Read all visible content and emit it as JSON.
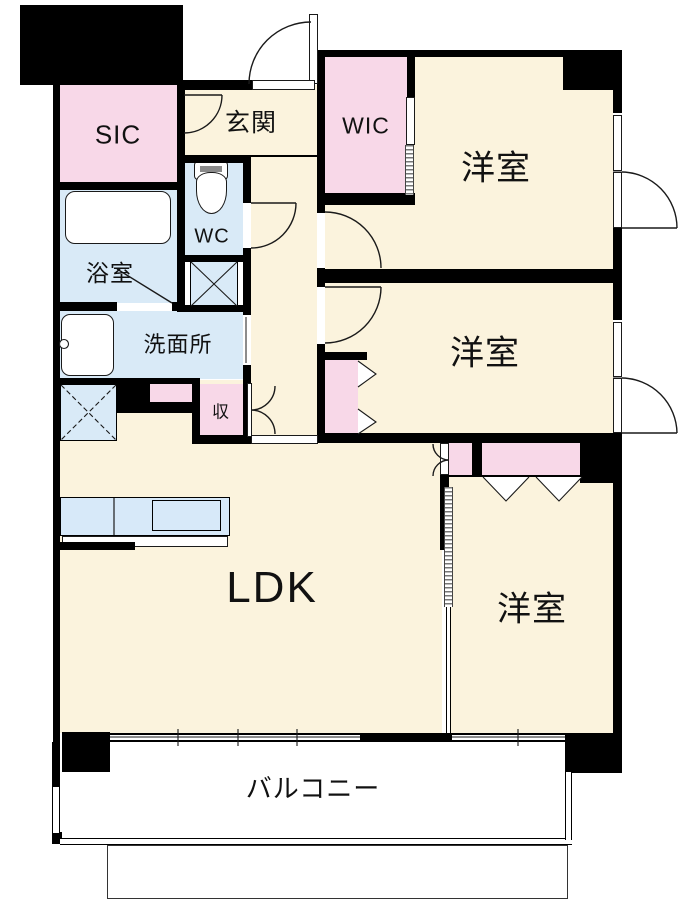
{
  "floorplan": {
    "type": "apartment-floor-plan",
    "rooms": {
      "sic": {
        "label": "SIC"
      },
      "genkan": {
        "label": "玄関"
      },
      "wic": {
        "label": "WIC"
      },
      "bedroom_top": {
        "label": "洋室"
      },
      "wc": {
        "label": "WC"
      },
      "bathroom": {
        "label": "浴室"
      },
      "washroom": {
        "label": "洗面所"
      },
      "bedroom_middle": {
        "label": "洋室"
      },
      "storage": {
        "label": "収"
      },
      "ldk": {
        "label": "LDK"
      },
      "bedroom_bottom": {
        "label": "洋室"
      },
      "balcony": {
        "label": "バルコニー"
      }
    },
    "colors": {
      "wall": "#000000",
      "room_floor": "#FBF3DD",
      "closet_pink": "#F8D8E8",
      "wet_area_blue": "#D9EAF7",
      "outside": "#FFFFFF"
    }
  }
}
